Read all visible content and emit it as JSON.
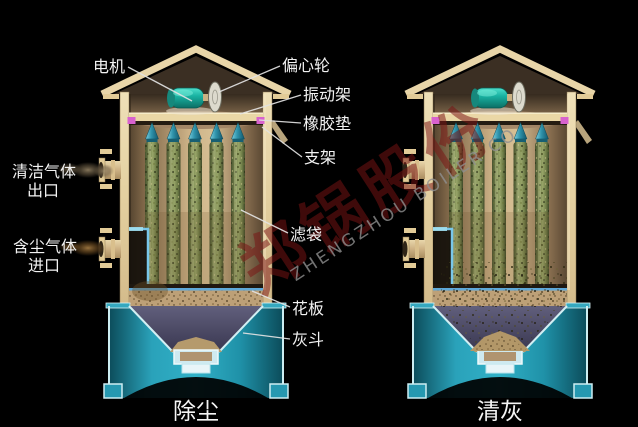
{
  "diagram": {
    "subject": "shaker-type baghouse dust collector, two operating states",
    "labels": {
      "motor": "电机",
      "eccentric_wheel": "偏心轮",
      "vibration_frame": "振动架",
      "rubber_pad": "橡胶垫",
      "support": "支架",
      "filter_bag": "滤袋",
      "tube_sheet": "花板",
      "ash_hopper": "灰斗",
      "clean_gas_line1": "清洁气体",
      "clean_gas_line2": "出口",
      "dusty_gas_line1": "含尘气体",
      "dusty_gas_line2": "进口"
    },
    "captions": {
      "left_vessel": "除尘",
      "right_vessel": "清灰"
    },
    "watermark": {
      "chinese": "郑锅股份",
      "latin": "ZHENGZHOU BOILER CO"
    },
    "colors": {
      "background": "#000000",
      "shell_tan": "#e3cf9f",
      "filter_bag_green": "#7d8a58",
      "bag_cap_teal": "#2f93ab",
      "motor_teal": "#19b2a2",
      "rubber_pad_pink": "#d862ce",
      "hopper_teal": "#2aa2ba",
      "hopper_border_cyan": "#cdeef2",
      "funnel_navy": "#4a4862",
      "tube_sheet_edge_blue": "#5fa8d8",
      "inlet_duct_blue": "#79c7ea",
      "dust_tan": "#b59a6c",
      "label_white": "#f2f2f2",
      "watermark_red": "#7a1414",
      "watermark_gray": "#8f8f8f"
    }
  }
}
